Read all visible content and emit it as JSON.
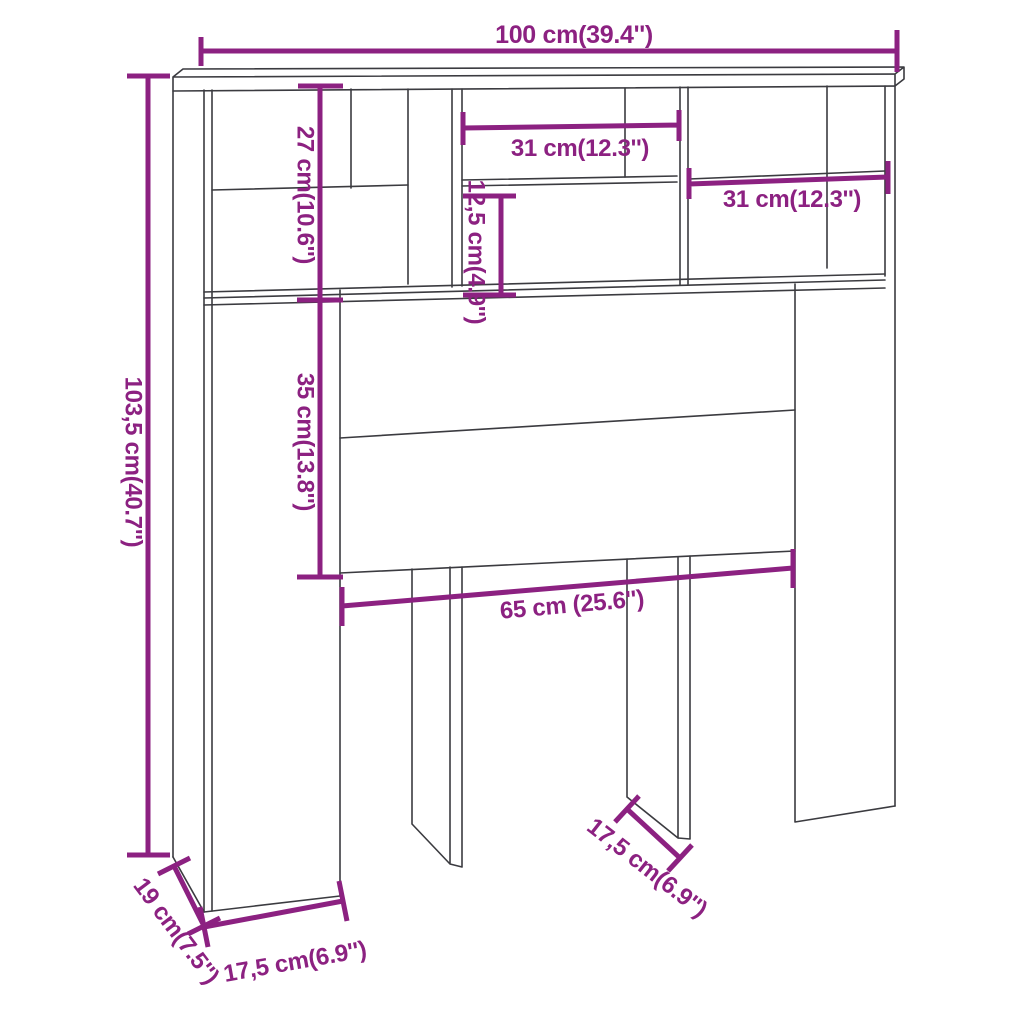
{
  "colors": {
    "accent": "#8C2181",
    "outline": "#3B3B40",
    "background": "#FFFFFF"
  },
  "labels": {
    "overall_width": "100 cm(39.4'')",
    "overall_height": "103,5 cm(40.7'')",
    "hutch_height": "27 cm(10.6'')",
    "middle_opening_width": "31 cm(12.3'')",
    "middle_lower_opening_height": "12,5 cm(4.9'')",
    "right_opening_width": "31 cm(12.3'')",
    "headboard_panel_height": "35 cm(13.8'')",
    "inner_span_width": "65 cm (25.6'')",
    "middle_leg_depth": "17,5 cm(6.9'')",
    "left_column_width": "17,5 cm(6.9'')",
    "side_panel_depth": "19 cm(7.5'')"
  }
}
